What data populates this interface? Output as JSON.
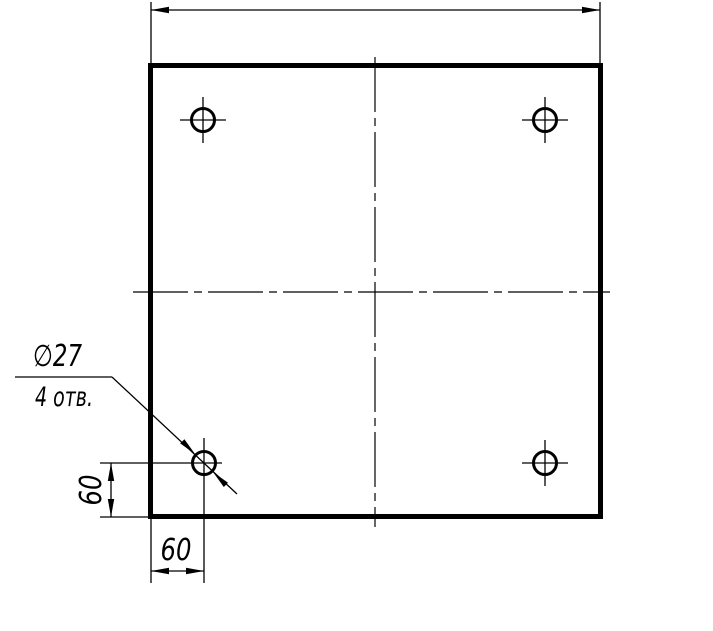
{
  "drawing": {
    "type": "engineering-drawing",
    "part": "square-plate-with-4-holes",
    "colors": {
      "line": "#000000",
      "background": "#ffffff"
    },
    "leader_note": {
      "diameter_label": "∅27",
      "count_label": "4 отв."
    },
    "dimensions": {
      "hole_offset_horizontal": "60",
      "hole_offset_vertical": "60",
      "overall_width_label": ""
    },
    "holes": {
      "count": 4,
      "positions": [
        "top-left",
        "top-right",
        "bottom-left",
        "bottom-right"
      ]
    }
  }
}
